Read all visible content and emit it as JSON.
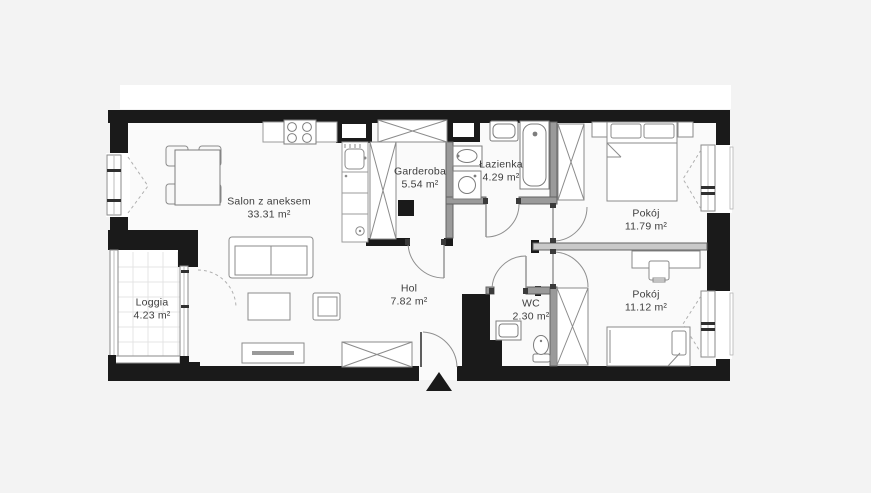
{
  "plan": {
    "type": "apartment-floorplan",
    "rooms": [
      {
        "id": "salon",
        "label": "Salon z aneksem",
        "area": "33.31 m²"
      },
      {
        "id": "garderoba",
        "label": "Garderoba",
        "area": "5.54 m²"
      },
      {
        "id": "lazienka",
        "label": "Łazienka",
        "area": "4.29 m²"
      },
      {
        "id": "pokoj-1",
        "label": "Pokój",
        "area": "11.79 m²"
      },
      {
        "id": "pokoj-2",
        "label": "Pokój",
        "area": "11.12 m²"
      },
      {
        "id": "hol",
        "label": "Hol",
        "area": "7.82 m²"
      },
      {
        "id": "wc",
        "label": "WC",
        "area": "2.30 m²"
      },
      {
        "id": "loggia",
        "label": "Loggia",
        "area": "4.23 m²"
      }
    ],
    "colors": {
      "background": "#f3f3f3",
      "floor": "#fafafa",
      "wall": "#1a1a1a",
      "partition_wall": "#9a9a9a",
      "furniture_line": "#8b8b8b",
      "label_text": "#3d3d3d",
      "banner": "#ffffff"
    }
  }
}
